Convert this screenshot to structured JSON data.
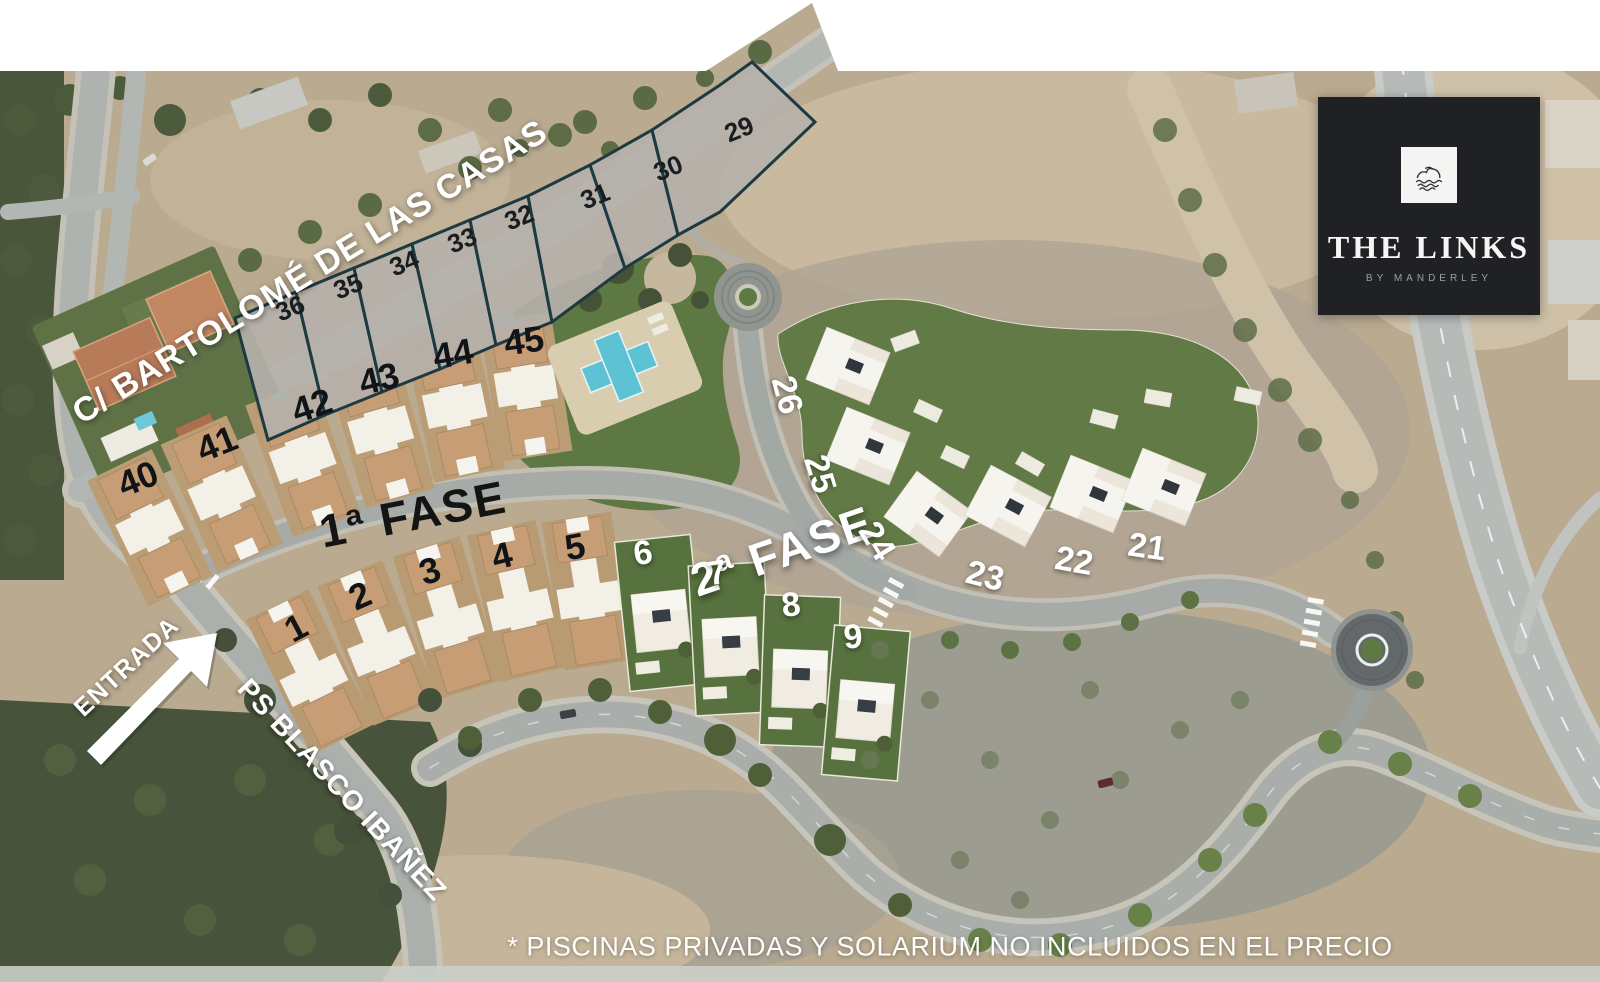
{
  "map": {
    "street_top": "C/ BARTOLOMÉ DE LAS CASAS",
    "street_entry": "PS BLASCO IBAÑEZ",
    "entrance_label": "ENTRADA",
    "phase1_label": "1ª FASE",
    "phase2_label": "2ª FASE",
    "disclaimer": "* PISCINAS PRIVADAS Y SOLARIUM NO INCLUIDOS EN EL PRECIO",
    "plots_vacant": {
      "p29": "29",
      "p30": "30",
      "p31": "31",
      "p32": "32",
      "p33": "33",
      "p34": "34",
      "p35": "35",
      "p36": "36"
    },
    "plots_phase1_upper": {
      "p40": "40",
      "p41": "41",
      "p42": "42",
      "p43": "43",
      "p44": "44",
      "p45": "45"
    },
    "plots_phase1_lower": {
      "p1": "1",
      "p2": "2",
      "p3": "3",
      "p4": "4",
      "p5": "5"
    },
    "plots_phase2_row": {
      "p6": "6",
      "p7": "7",
      "p8": "8",
      "p9": "9"
    },
    "plots_phase2_hill": {
      "p21": "21",
      "p22": "22",
      "p23": "23",
      "p24": "24",
      "p25": "25",
      "p26": "26"
    }
  },
  "logo": {
    "title": "THE LINKS",
    "subtitle": "BY MANDERLEY",
    "icon": "dunes-over-water-icon"
  },
  "colors": {
    "logo_background": "#1f2125",
    "plot_border": "#1d3a42",
    "pool_water": "#5cc2d4",
    "lawn_green": "#5d7842",
    "sand": "#b9aa90",
    "road_gray": "#a9aeab",
    "label_white": "#ffffff",
    "label_black": "#121416"
  }
}
